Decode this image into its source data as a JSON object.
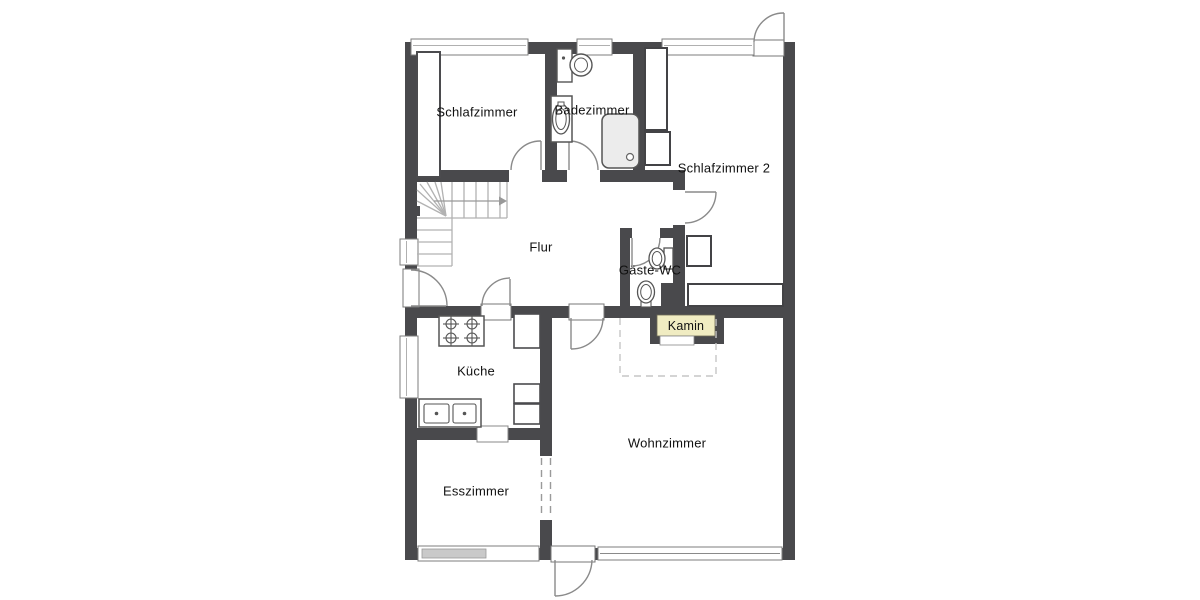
{
  "floor_plan": {
    "rooms": [
      {
        "id": "schlafzimmer",
        "name": "Schlafzimmer"
      },
      {
        "id": "badezimmer",
        "name": "Badezimmer"
      },
      {
        "id": "schlafzimmer-2",
        "name": "Schlafzimmer 2"
      },
      {
        "id": "flur",
        "name": "Flur"
      },
      {
        "id": "gaeste-wc",
        "name": "Gäste-WC"
      },
      {
        "id": "kueche",
        "name": "Küche"
      },
      {
        "id": "wohnzimmer",
        "name": "Wohnzimmer"
      },
      {
        "id": "esszimmer",
        "name": "Esszimmer"
      }
    ],
    "fireplace": {
      "label": "Kamin",
      "fill": "#f0ecc2"
    },
    "colors": {
      "wall": "#49494c",
      "floor": "#ffffff",
      "stairs": "#b2b2b2",
      "window_frame": "#7e7e7e",
      "door_arc": "#8a8a8a",
      "dashed": "#c6c6c6",
      "window_sill_gray": "#c9c9c9"
    },
    "fixtures": [
      "stairs",
      "wardrobe",
      "closet",
      "toilet",
      "bathroom-sink",
      "shower",
      "guest-wc-toilet",
      "guest-wc-sink",
      "stove",
      "kitchen-double-sink",
      "kitchen-counter",
      "fireplace",
      "hearth-zone"
    ]
  }
}
